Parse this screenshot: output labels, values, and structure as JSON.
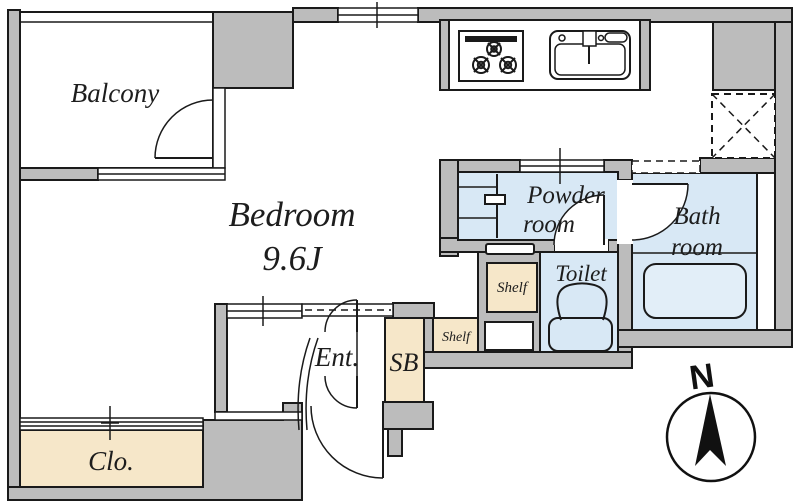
{
  "floor_plan": {
    "rooms": {
      "balcony": {
        "label": "Balcony"
      },
      "bedroom": {
        "label": "Bedroom",
        "size": "9.6J"
      },
      "powder_room": {
        "line1": "Powder",
        "line2": "room"
      },
      "bath_room": {
        "line1": "Bath",
        "line2": "room"
      },
      "toilet": {
        "label": "Toilet"
      },
      "shelf_upper": {
        "label": "Shelf"
      },
      "shelf_lower": {
        "label": "Shelf"
      },
      "entrance": {
        "label": "Ent."
      },
      "shoe_box": {
        "label": "SB"
      },
      "closet": {
        "label": "Clo."
      }
    },
    "fixtures": [
      "stove-icon",
      "sink-icon",
      "refrigerator-space-icon",
      "washing-machine-space-icon",
      "bathtub-icon",
      "toilet-icon"
    ],
    "compass": {
      "label": "N"
    },
    "colors": {
      "wall_fill": "#bcbcbc",
      "wet_area_fill": "#d8e8f5",
      "storage_fill": "#f6e7c9",
      "outline": "#1a1a1a",
      "background": "#ffffff"
    }
  }
}
